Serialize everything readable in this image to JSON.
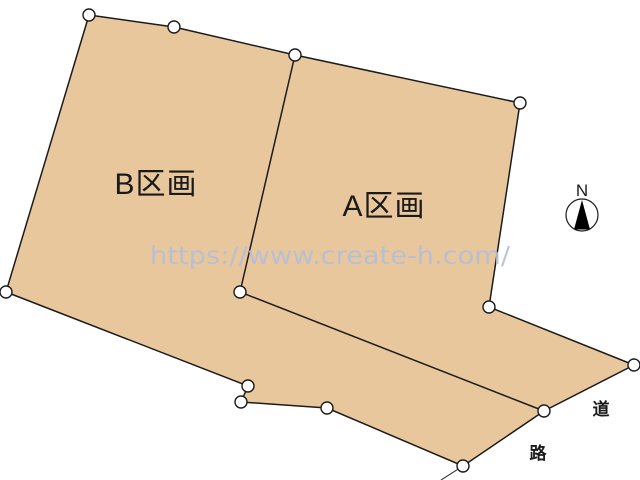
{
  "parcels": {
    "b_label": "B区画",
    "a_label": "A区画"
  },
  "road": {
    "label_top": "道",
    "label_bottom": "路"
  },
  "compass": {
    "north_label": "N"
  },
  "watermark": {
    "text": "https://www.create-h.com/",
    "color": "#b4bfd9"
  },
  "colors": {
    "parcel_fill": "#e9c79c",
    "outline": "#1b1b1b",
    "label_text": "#1a1a1a",
    "background": "#ffffff"
  }
}
